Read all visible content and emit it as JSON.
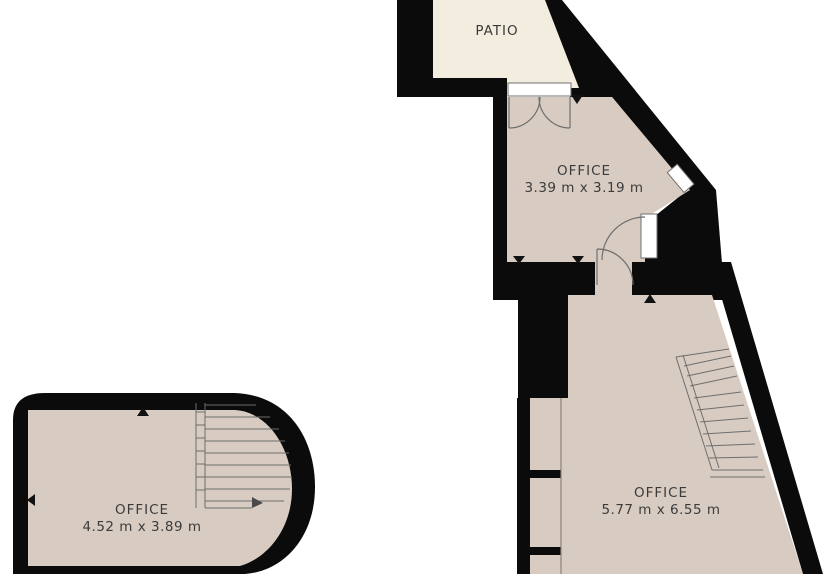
{
  "title": "Floor plan",
  "colors": {
    "background": "#ffffff",
    "wall": "#0b0b0b",
    "patio_floor": "#f2edde",
    "room_floor": "#d8ccc2",
    "label": "#3b3b3b",
    "detail_line": "#6e6e6e",
    "marker": "#111111"
  },
  "rooms": {
    "patio": {
      "label": "PATIO"
    },
    "office_top": {
      "label": "OFFICE",
      "dimensions": "3.39 m x 3.19 m"
    },
    "office_right": {
      "label": "OFFICE",
      "dimensions": "5.77 m x 6.55 m"
    },
    "office_left": {
      "label": "OFFICE",
      "dimensions": "4.52 m x 3.89 m"
    }
  },
  "features": {
    "double_door": "double-swing door between patio and top office",
    "door_right": "single door in right wall of top office",
    "door_passage": "single door in passage to right office",
    "window_diagonal": "window on diagonal wall",
    "stairs_left": "staircase in left office",
    "stairs_right": "staircase in right office"
  }
}
